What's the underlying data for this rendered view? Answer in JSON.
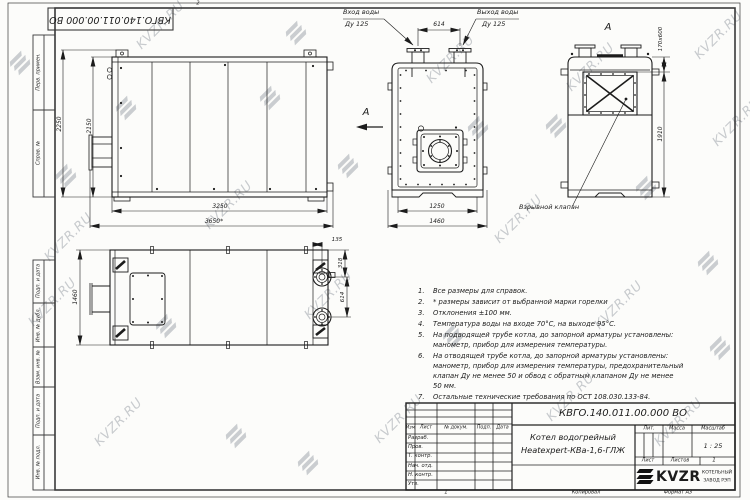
{
  "watermark": {
    "text": "KVZR.RU"
  },
  "frame": {
    "left_labels": [
      "Перв. примен.",
      "Справ. №",
      "Подп. и дата",
      "Инв. № дубл.",
      "Взам. инв. №",
      "Подп. и дата",
      "Инв. № подл."
    ],
    "copy": "Копировал",
    "format": "Формат А3",
    "mark_bottom": "1",
    "mark_top": "2"
  },
  "views": {
    "front": {
      "labels": {
        "inlet1": "Вход воды",
        "inlet2": "Ду 125",
        "outlet1": "Выход воды",
        "outlet2": "Ду 125",
        "arrow": "А"
      },
      "dims": {
        "pipe_spacing": "614",
        "body": "1250",
        "overall": "1460"
      }
    },
    "side": {
      "dims": {
        "h_outer": "2250",
        "h_body": "2150",
        "l_body": "3250",
        "l_overall": "3650*"
      }
    },
    "rear": {
      "title": "А",
      "valve_label": "Взрывной клапан",
      "dims": {
        "valve": "170х600",
        "height": "1910"
      }
    },
    "top": {
      "dims": {
        "width": "1460",
        "edge": "135",
        "first": "318",
        "spacing": "614"
      }
    }
  },
  "notes": {
    "items": [
      {
        "num": "1.",
        "text": "Все размеры для справок."
      },
      {
        "num": "2.",
        "text": "* размеры зависит от выбранной марки горелки"
      },
      {
        "num": "3.",
        "text": "Отклонения ±100 мм."
      },
      {
        "num": "4.",
        "text": "Температура воды на входе 70°С, на выходе 95°С."
      },
      {
        "num": "5.",
        "text": "На подводящей трубе котла, до запорной арматуры установлены:\nманометр, прибор для измерения температуры."
      },
      {
        "num": "6.",
        "text": "На отводящей трубе котла, до запорной арматуры установлены:\nманометр, прибор для измерения температуры, предохранительный\nклапан Ду не менее 50 и обвод с обратным клапаном Ду не менее\n50 мм."
      },
      {
        "num": "7.",
        "text": "Остальные технические требования по ОСТ 108.030.133-84."
      }
    ]
  },
  "title_block": {
    "designation": "КВГО.140.011.00.000 ВО",
    "name_line1": "Котел водогрейный",
    "name_line2": "Heatexpert-КВа-1,6-ГЛЖ",
    "col_izm": "Изм",
    "col_list": "Лист",
    "col_doc": "№ докум.",
    "col_podp": "Подп.",
    "col_data": "Дата",
    "rows": [
      "Разраб.",
      "Пров.",
      "Т. контр.",
      "Нач. отд.",
      "Н. контр.",
      "Утв."
    ],
    "lit": "Лит.",
    "mass": "Масса",
    "scale": "Масштаб",
    "scale_value": "1 : 25",
    "sheet": "Лист",
    "sheets": "Листов",
    "sheets_value": "1",
    "brand": "KVZR",
    "brand_line1": "КОТЕЛЬНЫЙ",
    "brand_line2": "ЗАВОД РЭП"
  },
  "colors": {
    "line": "#1c1c1c",
    "paper": "#fcfcfa",
    "watermark": "#949aa2"
  }
}
